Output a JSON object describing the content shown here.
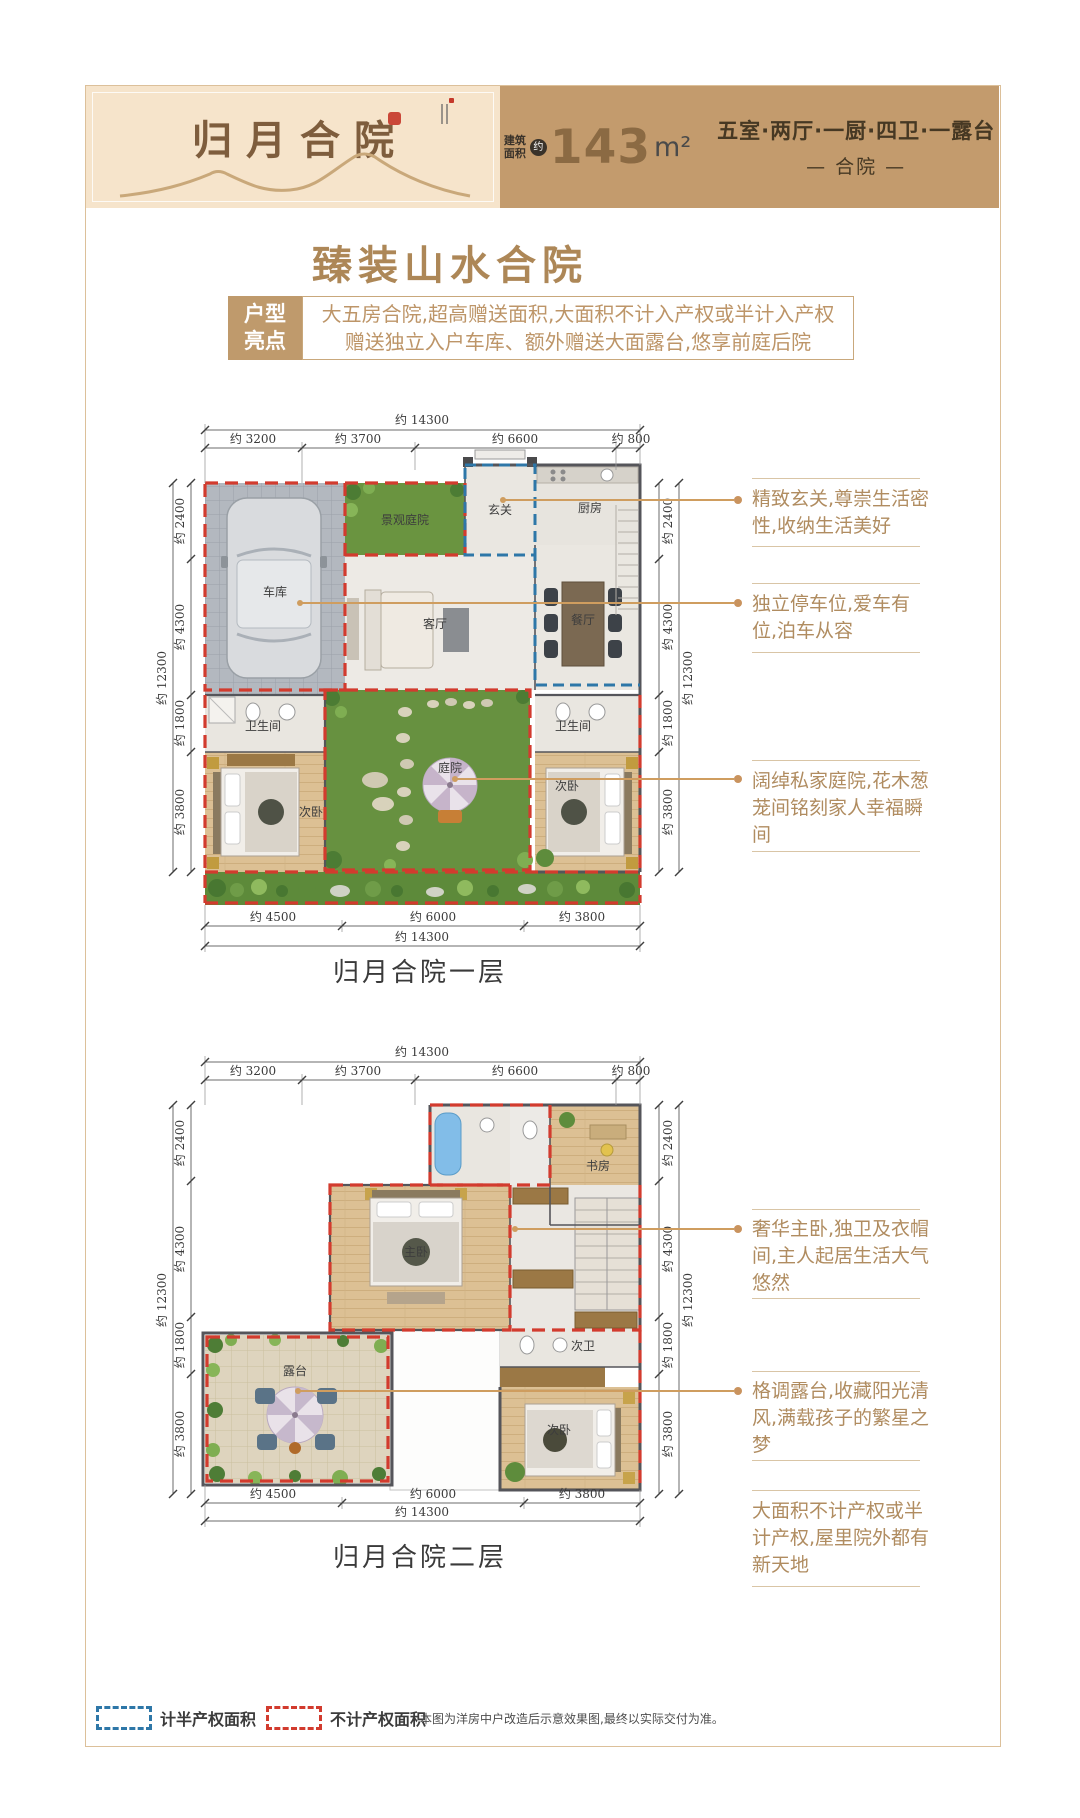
{
  "colors": {
    "accent_tan": "#bf9a6c",
    "header_bg": "#c39b6d",
    "title_brown": "#7e5d3d",
    "red_dashed": "#d23b2e",
    "blue_dashed": "#2e77a8",
    "annotation_text": "#b08c60"
  },
  "header": {
    "title": "归月合院",
    "area_label": "建筑面积",
    "area_approx": "约",
    "area_value": "143",
    "area_unit": "m²",
    "spec": "五室·两厅·一厨·四卫·一露台",
    "type_label": "— 合院 —"
  },
  "main_title": "臻装山水合院",
  "highlight": {
    "label": "户型亮点",
    "line1": "大五房合院,超高赠送面积,大面积不计入产权或半计入产权",
    "line2": "赠送独立入户车库、额外赠送大面露台,悠享前庭后院"
  },
  "floor1": {
    "caption": "归月合院一层",
    "dims": {
      "top_total": "约 14300",
      "top_segs": [
        "约 3200",
        "约 3700",
        "约 6600",
        "约 800"
      ],
      "side_total": "约 12300",
      "side_segs": [
        "约 2400",
        "约 4300",
        "约 1800",
        "约 3800"
      ],
      "bottom_segs": [
        "约 4500",
        "约 6000",
        "约 3800"
      ],
      "bottom_total": "约 14300"
    },
    "rooms": {
      "garage": "车库",
      "garden": "景观庭院",
      "foyer": "玄关",
      "kitchen": "厨房",
      "living": "客厅",
      "dining": "餐厅",
      "bath_left": "卫生间",
      "bed_left": "次卧",
      "courtyard": "庭院",
      "bath_right": "卫生间",
      "bed_right": "次卧"
    },
    "annotations": [
      {
        "text": "精致玄关,尊崇生活密性,收纳生活美好"
      },
      {
        "text": "独立停车位,爱车有位,泊车从容"
      },
      {
        "text": "阔绰私家庭院,花木葱茏间铭刻家人幸福瞬间"
      }
    ]
  },
  "floor2": {
    "caption": "归月合院二层",
    "dims": {
      "top_total": "约 14300",
      "top_segs": [
        "约 3200",
        "约 3700",
        "约 6600",
        "约 800"
      ],
      "side_total": "约 12300",
      "side_segs": [
        "约 2400",
        "约 4300",
        "约 1800",
        "约 3800"
      ],
      "bottom_segs": [
        "约 4500",
        "约 6000",
        "约 3800"
      ],
      "bottom_total": "约 14300"
    },
    "rooms": {
      "study": "书房",
      "master": "主卧",
      "terrace": "露台",
      "bath_second": "次卫",
      "bed_second": "次卧"
    },
    "annotations": [
      {
        "text": "奢华主卧,独卫及衣帽间,主人起居生活大气悠然"
      },
      {
        "text": "格调露台,收藏阳光清风,满载孩子的繁星之梦"
      },
      {
        "text": "大面积不计产权或半计产权,屋里院外都有新天地"
      }
    ]
  },
  "legend": {
    "half_property": "计半产权面积",
    "no_property": "不计产权面积",
    "disclaimer": "本图为洋房中户改造后示意效果图,最终以实际交付为准。"
  }
}
